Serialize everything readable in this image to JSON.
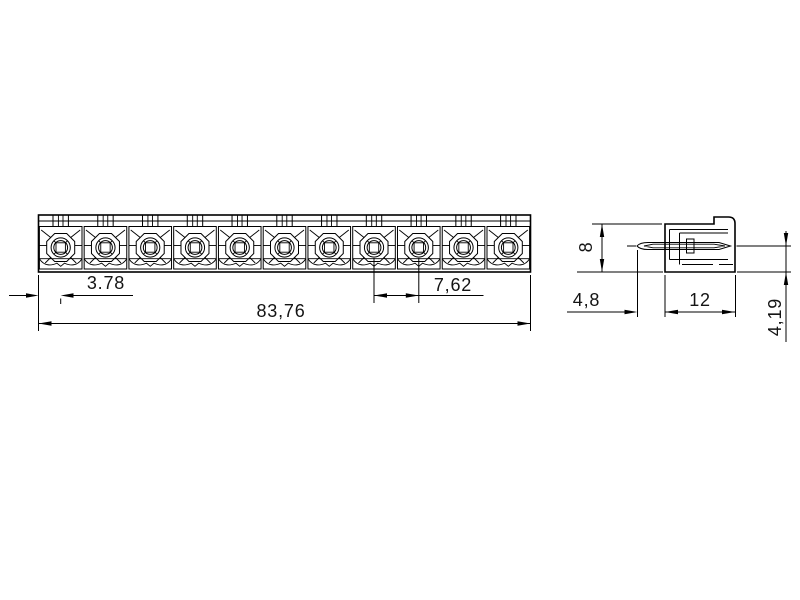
{
  "drawing": {
    "type": "technical-drawing",
    "colors": {
      "background": "#ffffff",
      "line": "#000000",
      "text": "#141414"
    },
    "front_view": {
      "positions": 11,
      "dimensions": {
        "edge_offset": "3.78",
        "overall_width": "83,76",
        "pitch": "7,62"
      }
    },
    "side_view": {
      "dimensions": {
        "height": "8",
        "pin_protrusion": "4,8",
        "depth": "12",
        "pin_axis_offset": "4,19"
      }
    }
  }
}
